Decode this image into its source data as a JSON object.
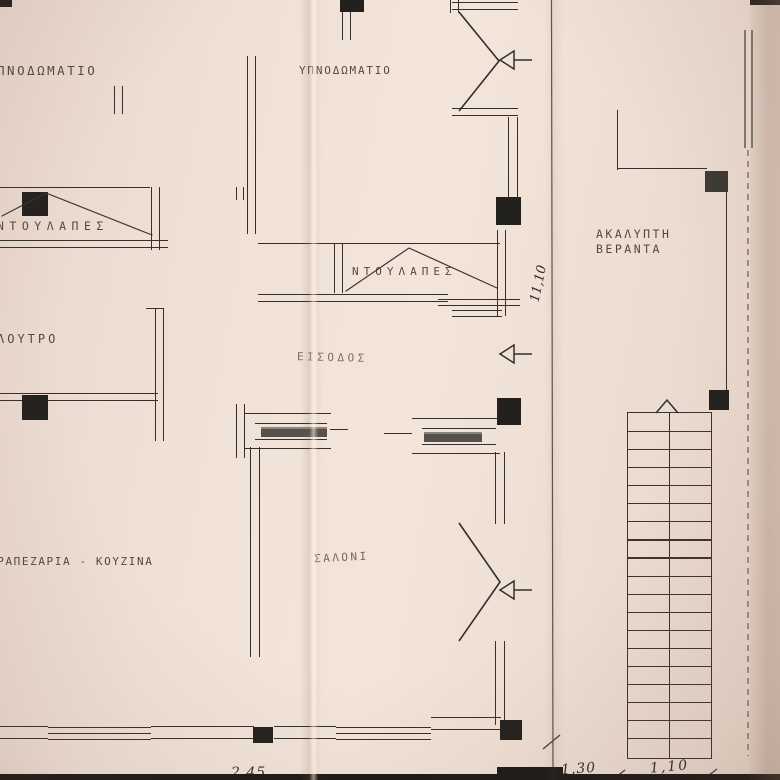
{
  "document": {
    "kind": "scanned architectural floor plan",
    "language": "Greek"
  },
  "rooms": {
    "bedroom_left": "ΥΠΝΟΔΩΜΑΤΙΟ",
    "bedroom_middle": "ΥΠΝΟΔΩΜΑΤΙΟ",
    "closet_left": "ΝΤΟΥΛΑΠΕΣ",
    "closet_middle": "ΝΤΟΥΛΑΠΕΣ",
    "bathroom": "ΛΟΥΤΡΟ",
    "entrance": "ΕΙΣΟΔΟΣ",
    "dining_kitchen": "ΤΡΑΠΕΖΑΡΙΑ - ΚΟΥΖΙΝΑ",
    "living_room": "ΣΑΛΟΝΙ",
    "veranda_line1": "ΑΚΑΛΥΠΤΗ",
    "veranda_line2": "ΒΕΡΑΝΤΑ"
  },
  "dimensions": {
    "right_vertical": "11,10",
    "bottom_left": "2,45",
    "bottom_middle": "1,30",
    "bottom_right": "1,10"
  },
  "stairs": {
    "steps": 19,
    "direction": "up"
  },
  "colors": {
    "paper": "#f0e1d6",
    "ink": "#35302b",
    "column_fill": "#23211e"
  }
}
